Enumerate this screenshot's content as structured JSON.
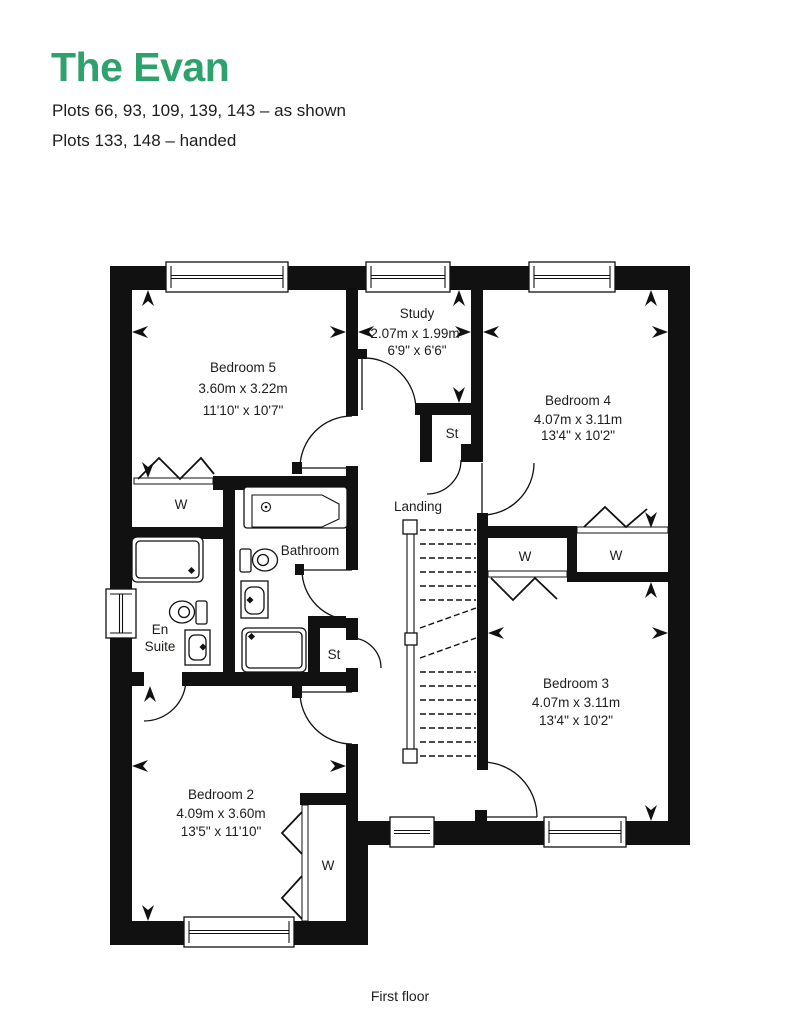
{
  "header": {
    "title": "The Evan",
    "plots_line1": "Plots 66, 93, 109, 139, 143 – as shown",
    "plots_line2": "Plots 133, 148 – handed"
  },
  "caption": "First floor",
  "colors": {
    "accent": "#2EA26C",
    "wall": "#111111",
    "text": "#1D1D1B"
  },
  "rooms": {
    "bedroom5": {
      "name": "Bedroom 5",
      "metric": "3.60m x 3.22m",
      "imperial": "11'10\" x 10'7\""
    },
    "study": {
      "name": "Study",
      "metric": "2.07m x 1.99m",
      "imperial": "6'9\" x 6'6\""
    },
    "bedroom4": {
      "name": "Bedroom 4",
      "metric": "4.07m x 3.11m",
      "imperial": "13'4\" x 10'2\""
    },
    "bedroom3": {
      "name": "Bedroom 3",
      "metric": "4.07m x 3.11m",
      "imperial": "13'4\" x 10'2\""
    },
    "bedroom2": {
      "name": "Bedroom 2",
      "metric": "4.09m x 3.60m",
      "imperial": "13'5\" x 11'10\""
    },
    "landing": {
      "name": "Landing"
    },
    "bathroom": {
      "name": "Bathroom"
    },
    "ensuite": {
      "name_line1": "En",
      "name_line2": "Suite"
    }
  },
  "labels": {
    "wardrobe": "W",
    "store": "St"
  }
}
